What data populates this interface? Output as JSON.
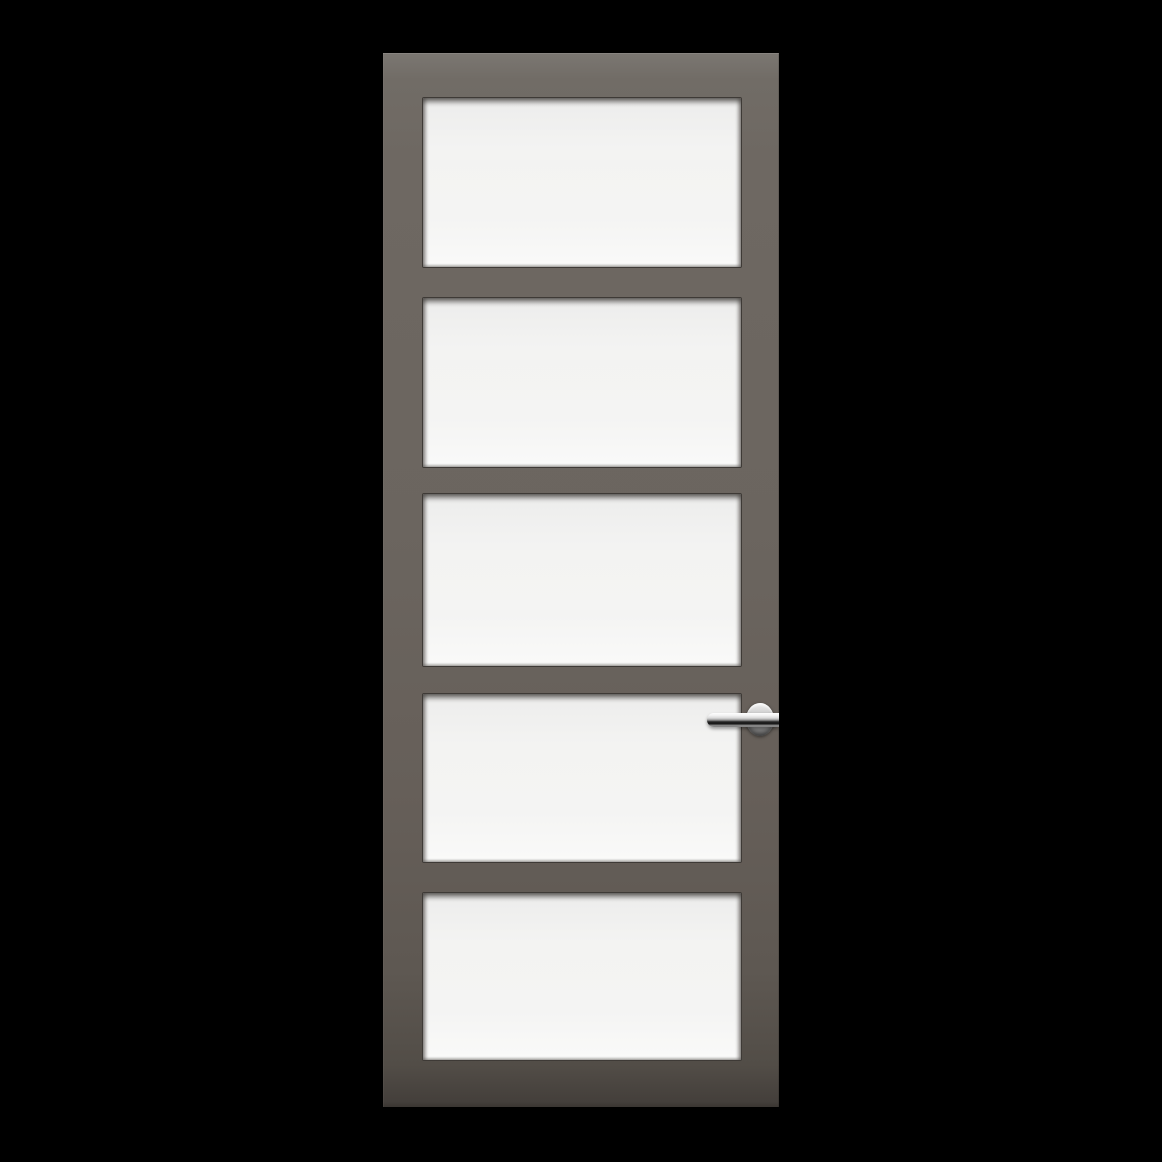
{
  "meta": {
    "description": "Product photograph of a five-panel glazed interior door with a dark grey-brown frame and a chrome lever handle on the right stile, shown on a solid black background"
  },
  "colors": {
    "background": "#000000",
    "frame": "#6e6862",
    "frame_bottom": "#443f3b",
    "glass": "#f3f3f2",
    "glass_bevel": "#3e3a36",
    "handle_chrome": "#d8d8d8",
    "handle_dark_stripe": "#101010"
  },
  "door": {
    "panel_count": 5,
    "panel_layout": "five equal horizontal glass panes stacked vertically",
    "handle": {
      "type": "lever-on-round-rose",
      "finish": "polished chrome",
      "side": "right",
      "vertical_position": "beside fourth panel"
    }
  }
}
